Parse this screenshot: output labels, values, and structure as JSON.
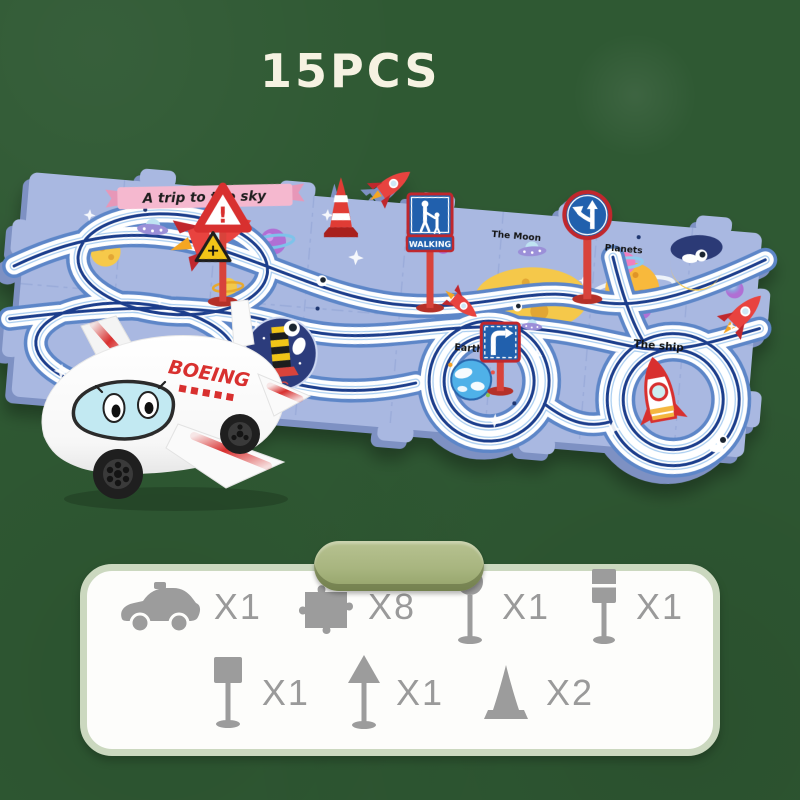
{
  "header": {
    "title": "15PCS"
  },
  "mat": {
    "banner": "A trip to the sky",
    "labels": {
      "moon": "The Moon",
      "planets": "Planets",
      "earth": "Earth",
      "ship": "The ship"
    },
    "walking": "WALKING",
    "warn_glyph": "!",
    "cross_glyph": "+"
  },
  "plane": {
    "brand": "BOEING"
  },
  "parts": {
    "items": [
      {
        "name": "car",
        "count": "X1"
      },
      {
        "name": "puzzle-piece",
        "count": "X8"
      },
      {
        "name": "round-sign",
        "count": "X1"
      },
      {
        "name": "signal-sign",
        "count": "X1"
      },
      {
        "name": "square-sign",
        "count": "X1"
      },
      {
        "name": "triangle-sign",
        "count": "X1"
      },
      {
        "name": "traffic-cone",
        "count": "X2"
      }
    ]
  },
  "colors": {
    "background": "#2f5933",
    "mat": "#a9b8e1",
    "mat_edge": "#7e91c3",
    "track_navy": "#1c3e8c",
    "accent_red": "#d8302f",
    "sign_blue": "#2160ad",
    "pill_green": "#a8b57f",
    "panel_border": "#cbd8bf",
    "icon_gray": "#9c9c9c"
  }
}
